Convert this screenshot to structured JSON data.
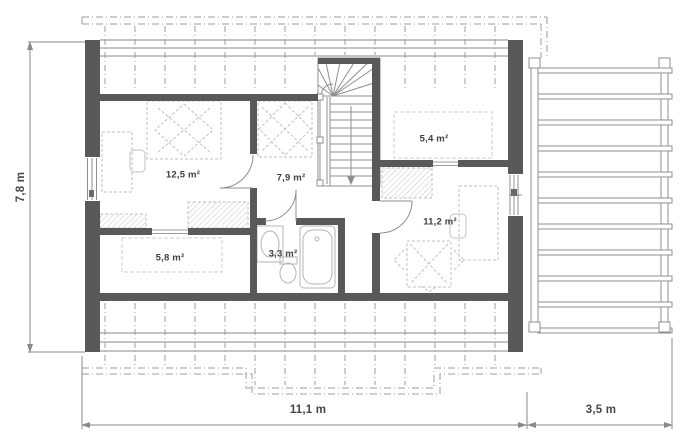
{
  "plan": {
    "name": "Attic floor plan",
    "rooms": [
      {
        "key": "bedroom-left",
        "area_label": "12,5 m²"
      },
      {
        "key": "hall",
        "area_label": "7,9 m²"
      },
      {
        "key": "room-top-right",
        "area_label": "5,4 m²"
      },
      {
        "key": "room-right",
        "area_label": "11,2 m²"
      },
      {
        "key": "room-bottom-left",
        "area_label": "5,8 m²"
      },
      {
        "key": "bathroom",
        "area_label": "3,3 m²"
      }
    ],
    "dimensions": {
      "overall_depth": "7,8 m",
      "overall_width": "11,1 m",
      "terrace_width": "3,5 m"
    },
    "colors": {
      "wall": "#595959",
      "thin_line": "#8a8a8a",
      "furniture_line": "#c2c2c2",
      "label_text": "#3f3f3f",
      "background": "#ffffff"
    }
  }
}
